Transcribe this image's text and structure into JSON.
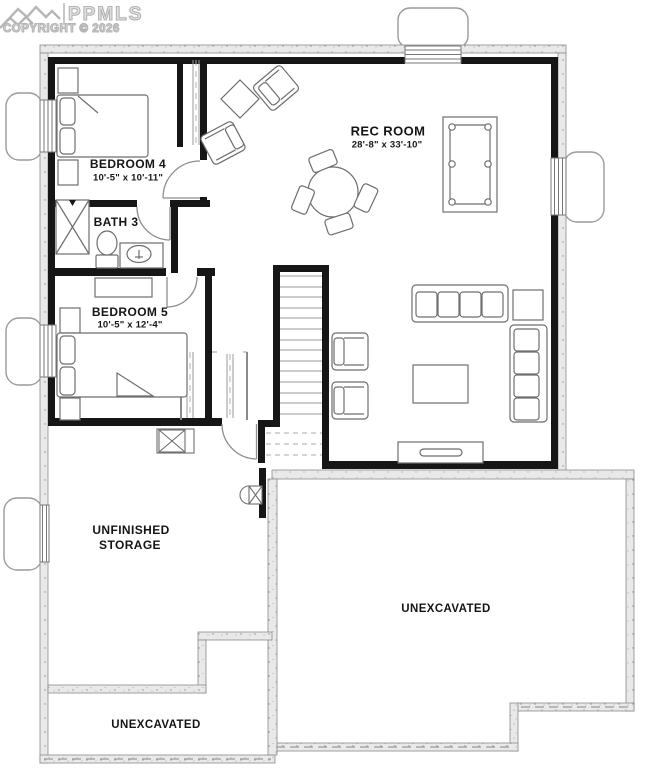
{
  "watermark": {
    "brand": "PPMLS",
    "copyright": "COPYRIGHT © 2026",
    "logo": "mountain-peaks-icon"
  },
  "rooms": {
    "bedroom4": {
      "name": "BEDROOM 4",
      "dims": "10'-5\" x 10'-11\""
    },
    "bath3": {
      "name": "BATH 3"
    },
    "bedroom5": {
      "name": "BEDROOM 5",
      "dims": "10'-5\" x 12'-4\""
    },
    "rec_room": {
      "name": "REC ROOM",
      "dims": "28'-8\" x 33'-10\""
    },
    "storage": {
      "line1": "UNFINISHED",
      "line2": "STORAGE"
    },
    "unexcavated_right": {
      "name": "UNEXCAVATED"
    },
    "unexcavated_bottom": {
      "name": "UNEXCAVATED"
    }
  },
  "colors": {
    "interior_wall": "#161616",
    "foundation_edge": "#8a8a8a",
    "furniture_line": "#6e6e6e",
    "watermark": "#b3b3b3"
  }
}
